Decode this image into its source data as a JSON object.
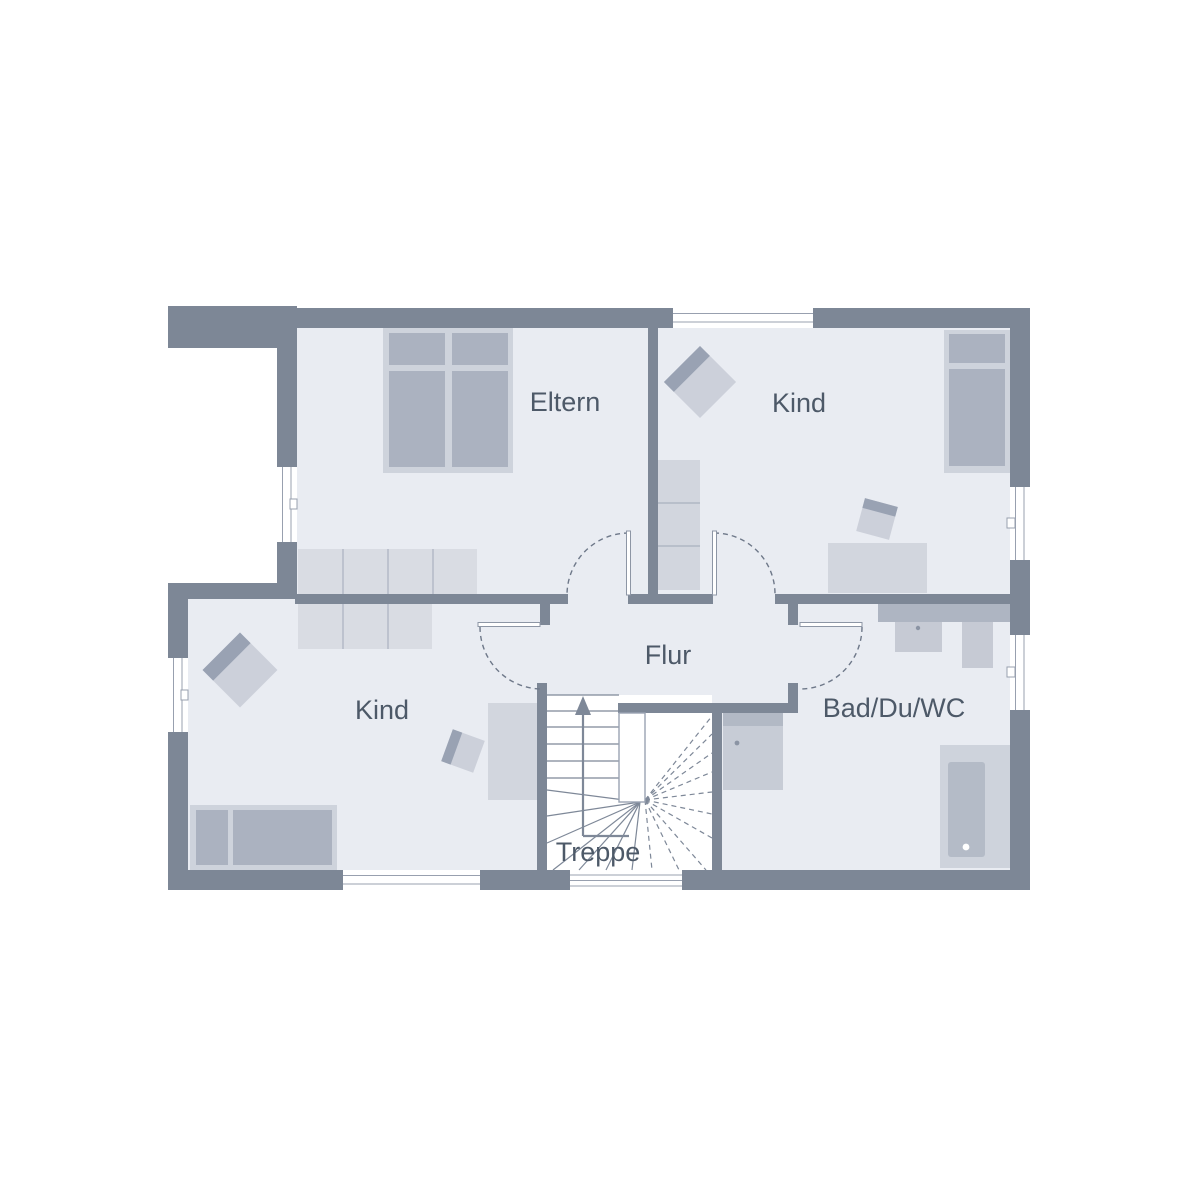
{
  "plan": {
    "type": "floor-plan",
    "rooms": [
      {
        "name": "eltern",
        "label": "Eltern"
      },
      {
        "name": "kind-top",
        "label": "Kind"
      },
      {
        "name": "kind-bottom",
        "label": "Kind"
      },
      {
        "name": "flur",
        "label": "Flur"
      },
      {
        "name": "bad-du-wc",
        "label": "Bad/Du/WC"
      },
      {
        "name": "treppe",
        "label": "Treppe"
      }
    ],
    "stairs": {
      "direction": "up",
      "type": "winder-staircase"
    },
    "counts": {
      "windows": 7,
      "interior_doors": 4
    },
    "furniture": [
      "double-bed",
      "wardrobe",
      "armchair",
      "single-bed",
      "shelf",
      "desk",
      "desk-chair",
      "vanity-sink",
      "wc",
      "shower",
      "bathtub"
    ],
    "colors": {
      "wall": "#7d8796",
      "floor": "#e9ecf2",
      "outside": "#ffffff",
      "furniture_light": "#ced3dc",
      "furniture_medium": "#abb2c0",
      "furniture_accent": "#99a2b3",
      "label_text": "#4d5968"
    }
  }
}
